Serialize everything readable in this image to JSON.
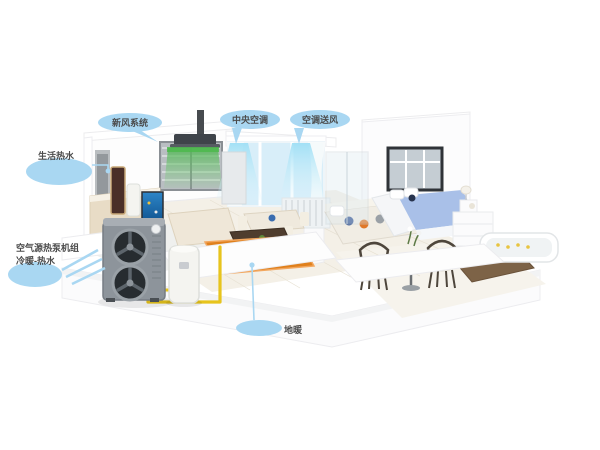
{
  "diagram": {
    "type": "cutaway-house-hvac-system",
    "labels": {
      "fresh_air": "新风系统",
      "central_ac": "中央空调",
      "ac_supply": "空调送风",
      "hot_water": "生活热水",
      "heat_pump_line1": "空气源热泵机组",
      "heat_pump_line2": "冷暖-热水",
      "floor_heating": "地暖"
    },
    "colors": {
      "label_bubble": "#a9d7f2",
      "label_text": "#4b4b4b",
      "airflow_green": "#53b656",
      "airflow_cyan": "#b5e7f7",
      "floor_heating_orange": "#e0801c",
      "pipe_yellow": "#e7c41d",
      "heat_pump_body": "#8d949b",
      "fan_dark": "#2b3136",
      "bed_blue": "#a9c0e8",
      "flower_red": "#c23b4e"
    }
  }
}
